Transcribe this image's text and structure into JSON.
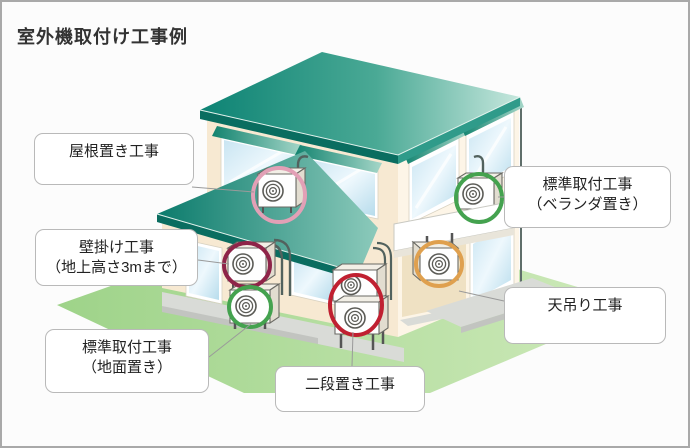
{
  "title": "室外機取付け工事例",
  "labels": {
    "roof": {
      "lines": [
        "屋根置き工事"
      ]
    },
    "wall": {
      "lines": [
        "壁掛け工事",
        "（地上高さ3mまで）"
      ]
    },
    "ground": {
      "lines": [
        "標準取付工事",
        "（地面置き）"
      ]
    },
    "two_tier": {
      "lines": [
        "二段置き工事"
      ]
    },
    "veranda": {
      "lines": [
        "標準取付工事",
        "（ベランダ置き）"
      ]
    },
    "ceiling": {
      "lines": [
        "天吊り工事"
      ]
    }
  },
  "markers": {
    "roof": "#e2a0b6",
    "wall": "#8e2449",
    "ground": "#44a24f",
    "two_tier": "#c02031",
    "veranda": "#44a24f",
    "ceiling": "#dfa04e"
  },
  "palette": {
    "roof_dark": "#0d8374",
    "roof_light": "#c6e7dd",
    "lower_roof_dark": "#0b7b6c",
    "lower_roof_light": "#8ccabb",
    "awning_dark": "#12836f",
    "awning_light": "#a5d6c8",
    "wall_left": "#f7e9d2",
    "wall_right": "#fdf5e7",
    "porch_shade": "#efe1c3",
    "grass_dark": "#9ed389",
    "grass_light": "#cfeabb",
    "glass": "#c9e5f2",
    "walkway": "#d9dbd7",
    "walkway_edge": "#c2c4c0",
    "fascia_dark": "#0a6d60",
    "fascia_mid": "#2f9b8a",
    "pipe": "#52625e",
    "connector": "#9a9a9a"
  }
}
